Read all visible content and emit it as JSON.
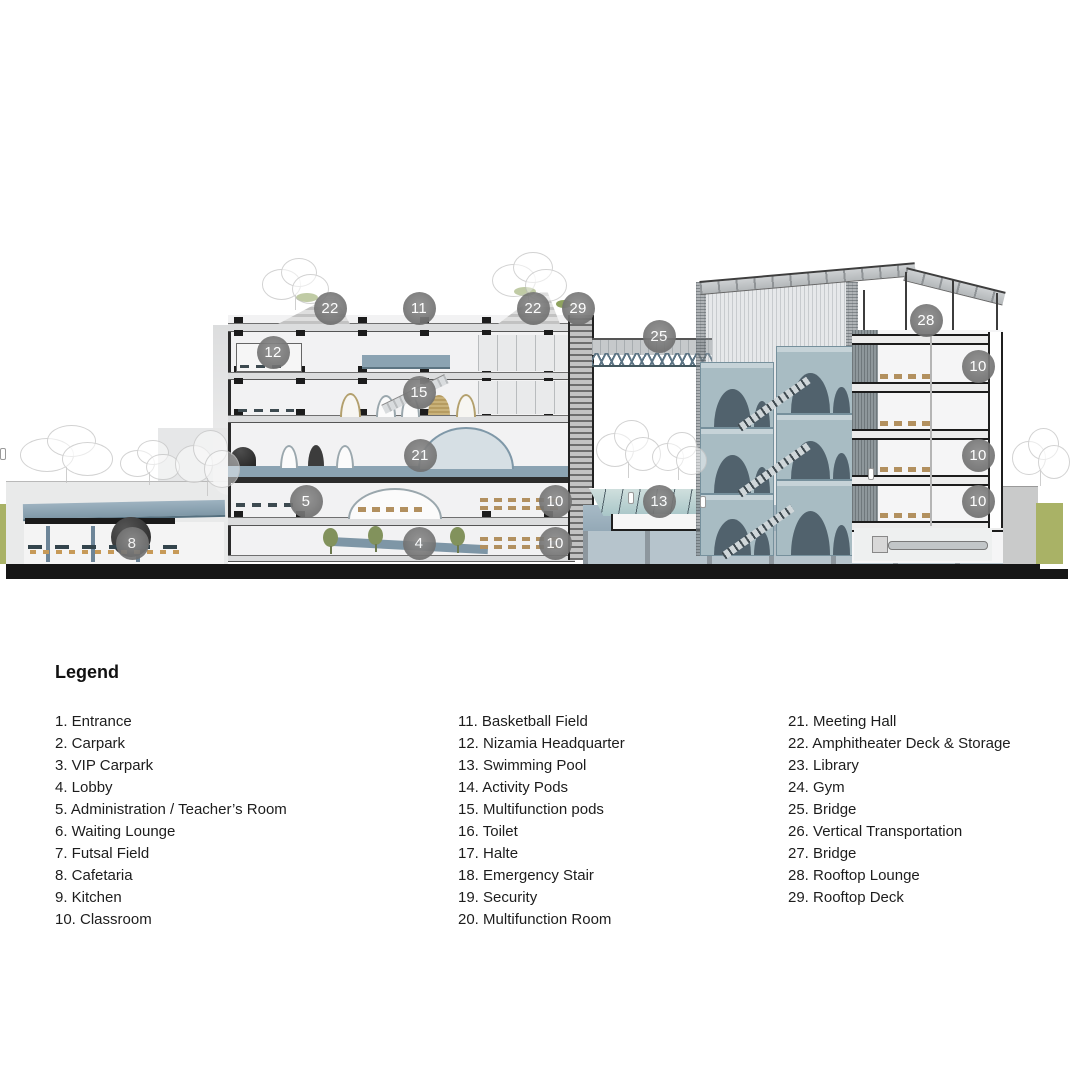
{
  "legend": {
    "title": "Legend",
    "columns": [
      [
        {
          "n": "1",
          "label": "Entrance"
        },
        {
          "n": "2",
          "label": "Carpark"
        },
        {
          "n": "3",
          "label": "VIP Carpark"
        },
        {
          "n": "4",
          "label": "Lobby"
        },
        {
          "n": "5",
          "label": "Administration / Teacher’s Room"
        },
        {
          "n": "6",
          "label": "Waiting Lounge"
        },
        {
          "n": "7",
          "label": "Futsal Field"
        },
        {
          "n": "8",
          "label": "Cafetaria"
        },
        {
          "n": "9",
          "label": "Kitchen"
        },
        {
          "n": "10",
          "label": "Classroom"
        }
      ],
      [
        {
          "n": "11",
          "label": "Basketball Field"
        },
        {
          "n": "12",
          "label": "Nizamia Headquarter"
        },
        {
          "n": "13",
          "label": "Swimming Pool"
        },
        {
          "n": "14",
          "label": "Activity Pods"
        },
        {
          "n": "15",
          "label": "Multifunction pods"
        },
        {
          "n": "16",
          "label": "Toilet"
        },
        {
          "n": "17",
          "label": "Halte"
        },
        {
          "n": "18",
          "label": "Emergency Stair"
        },
        {
          "n": "19",
          "label": "Security"
        },
        {
          "n": "20",
          "label": "Multifunction Room"
        }
      ],
      [
        {
          "n": "21",
          "label": "Meeting Hall"
        },
        {
          "n": "22",
          "label": "Amphitheater Deck & Storage"
        },
        {
          "n": "23",
          "label": "Library"
        },
        {
          "n": "24",
          "label": "Gym"
        },
        {
          "n": "25",
          "label": "Bridge"
        },
        {
          "n": "26",
          "label": "Vertical Transportation"
        },
        {
          "n": "27",
          "label": "Bridge"
        },
        {
          "n": "28",
          "label": "Rooftop Lounge"
        },
        {
          "n": "29",
          "label": "Rooftop Deck"
        }
      ]
    ]
  },
  "markers": [
    {
      "number": "22",
      "x": 330,
      "y": 308
    },
    {
      "number": "11",
      "x": 419,
      "y": 308
    },
    {
      "number": "22",
      "x": 533,
      "y": 308
    },
    {
      "number": "29",
      "x": 578,
      "y": 308
    },
    {
      "number": "25",
      "x": 659,
      "y": 336
    },
    {
      "number": "28",
      "x": 926,
      "y": 320
    },
    {
      "number": "12",
      "x": 273,
      "y": 352
    },
    {
      "number": "10",
      "x": 978,
      "y": 366
    },
    {
      "number": "15",
      "x": 419,
      "y": 392
    },
    {
      "number": "21",
      "x": 420,
      "y": 455
    },
    {
      "number": "10",
      "x": 978,
      "y": 455
    },
    {
      "number": "5",
      "x": 306,
      "y": 501
    },
    {
      "number": "10",
      "x": 555,
      "y": 501
    },
    {
      "number": "13",
      "x": 659,
      "y": 501
    },
    {
      "number": "10",
      "x": 978,
      "y": 501
    },
    {
      "number": "8",
      "x": 132,
      "y": 543
    },
    {
      "number": "4",
      "x": 419,
      "y": 543
    },
    {
      "number": "10",
      "x": 555,
      "y": 543
    }
  ],
  "colors": {
    "ground": "#161616",
    "olive": "#a9b266",
    "slate": "#8ba3b2",
    "pod": "#a8bcc3",
    "pod_arch": "#51626d",
    "marker_gray": "#757575",
    "text": "#1d1d1d"
  }
}
